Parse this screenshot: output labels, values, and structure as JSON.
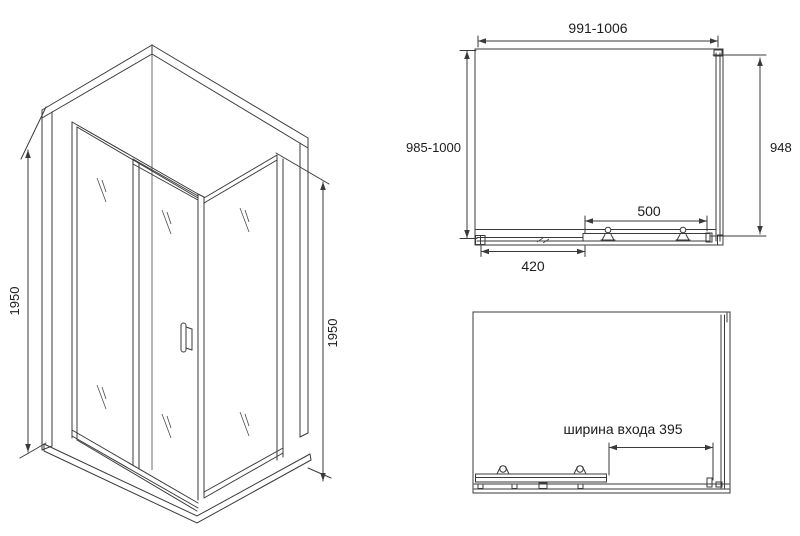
{
  "views": {
    "isometric": {
      "dim_left": "1950",
      "dim_right": "1950"
    },
    "plan": {
      "dim_width": "991-1006",
      "dim_depth": "985-1000",
      "dim_side": "948",
      "dim_door": "500",
      "dim_fixed": "420"
    },
    "elevation": {
      "dim_entry": "ширина входа 395"
    }
  },
  "colors": {
    "line": "#3a3a3a",
    "text": "#1c1c1c",
    "background": "#ffffff"
  }
}
